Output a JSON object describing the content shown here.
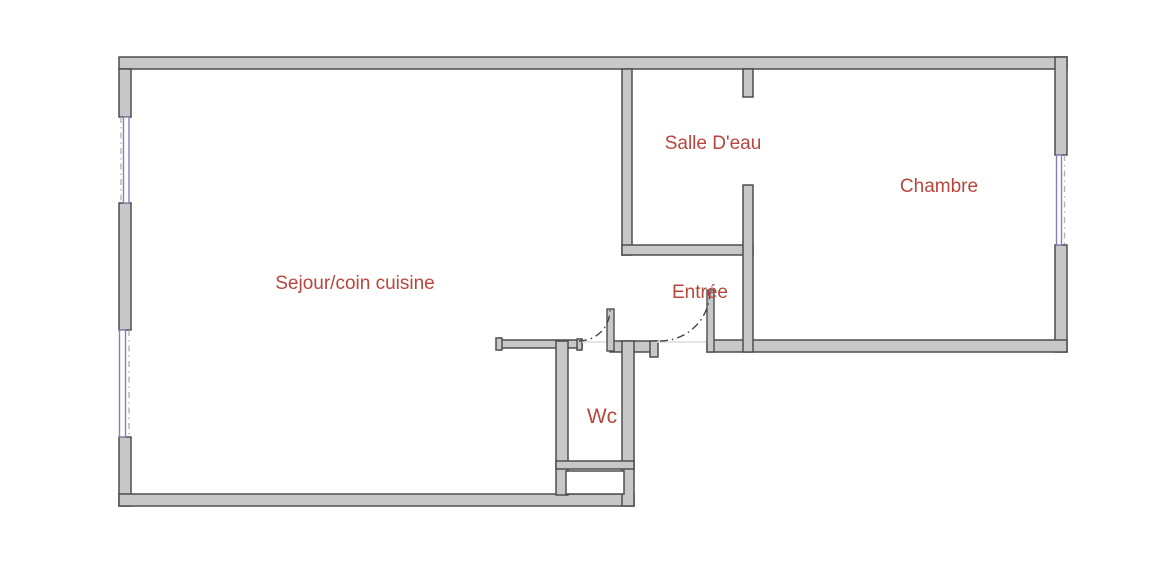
{
  "plan": {
    "rooms": [
      {
        "id": "sejour",
        "label": "Sejour/coin cuisine"
      },
      {
        "id": "salle-deau",
        "label": "Salle D'eau"
      },
      {
        "id": "chambre",
        "label": "Chambre"
      },
      {
        "id": "entree",
        "label": "Entrée"
      },
      {
        "id": "wc",
        "label": "Wc"
      }
    ]
  },
  "colors": {
    "background": "#ffffff",
    "wall_fill": "#c8c8c8",
    "wall_stroke": "#4d4d4d",
    "window_frame": "#8282b8",
    "window_dash": "#b4b4b4",
    "door_arc": "#444444",
    "threshold": "#dcdcdc",
    "label_red": "#b9453e"
  }
}
